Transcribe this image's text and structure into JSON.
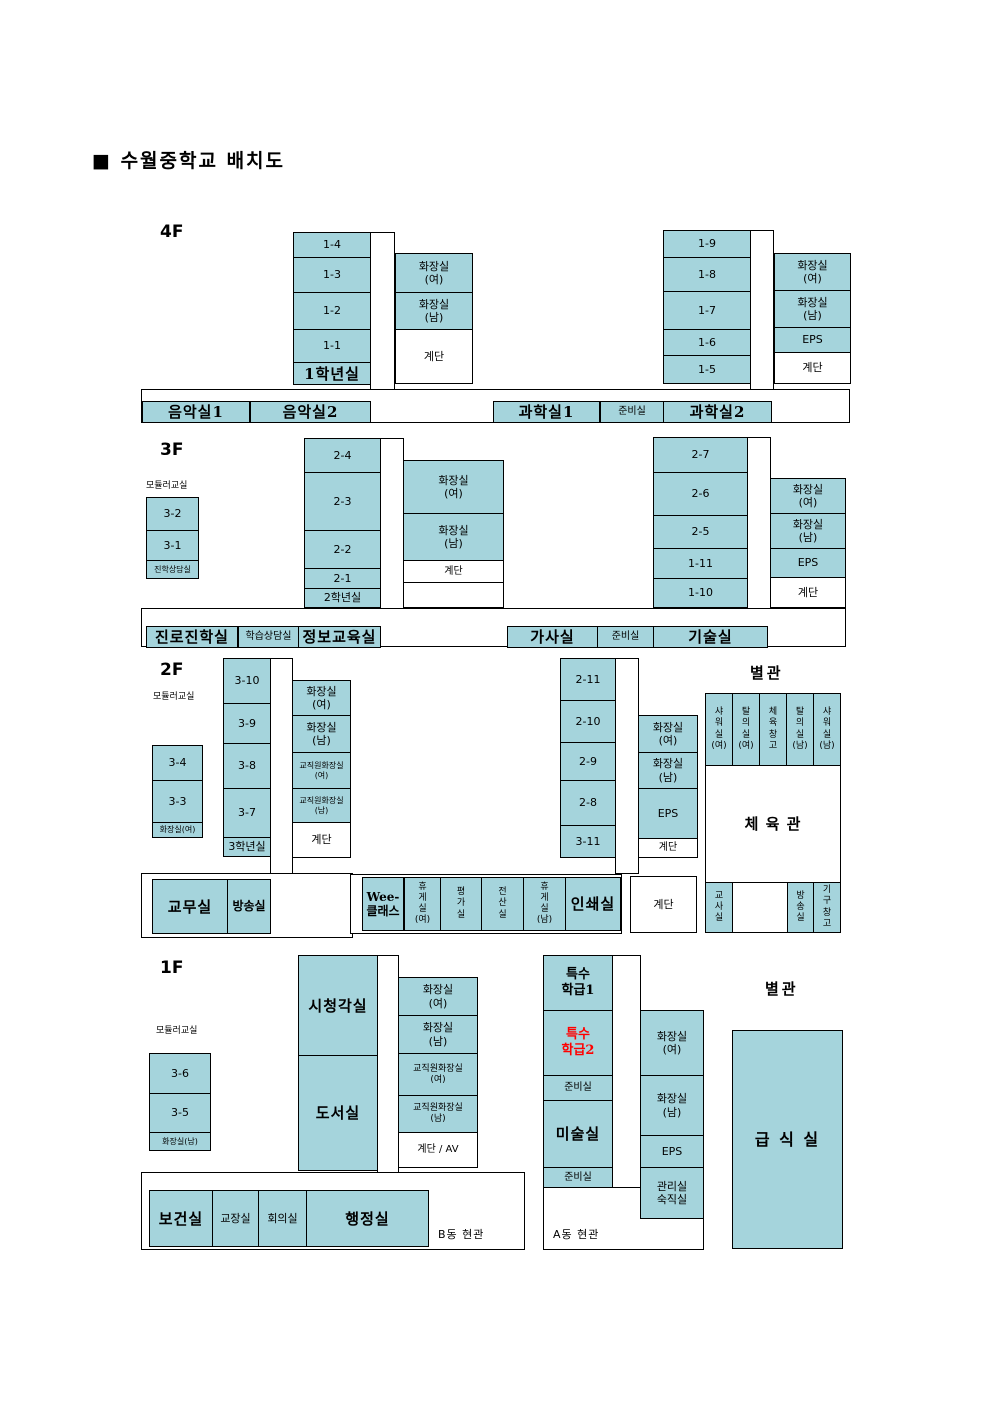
{
  "title": "■ 수월중학교 배치도",
  "colors": {
    "room_fill": "#a5d4dc",
    "line": "#000000",
    "highlight_text": "#ff0000"
  },
  "f4": {
    "label": "4F",
    "rooms_left": [
      "1-4",
      "1-3",
      "1-2",
      "1-1"
    ],
    "grade_office": "1학년실",
    "wc_left": [
      "화장실\n(여)",
      "화장실\n(남)"
    ],
    "stairs": "계단",
    "music_rooms": [
      "음악실1",
      "음악실2"
    ],
    "rooms_right": [
      "1-9",
      "1-8",
      "1-7",
      "1-6",
      "1-5"
    ],
    "wc_right": [
      "화장실\n(여)",
      "화장실\n(남)",
      "EPS"
    ],
    "science_rooms": [
      "과학실1",
      "준비실",
      "과학실2"
    ]
  },
  "f3": {
    "label": "3F",
    "modular_label": "모듈러교실",
    "modular_rooms": [
      "3-2",
      "3-1"
    ],
    "counsel_room": "진학상담실",
    "rooms_left": [
      "2-4",
      "2-3",
      "2-2",
      "2-1"
    ],
    "grade_office": "2학년실",
    "wc_left": [
      "화장실\n(여)",
      "화장실\n(남)"
    ],
    "stairs": "계단",
    "bottom_left": [
      "진로진학실",
      "학습상담실",
      "정보교육실"
    ],
    "rooms_right": [
      "2-7",
      "2-6",
      "2-5",
      "1-11",
      "1-10"
    ],
    "wc_right": [
      "화장실\n(여)",
      "화장실\n(남)",
      "EPS"
    ],
    "bottom_right": [
      "가사실",
      "준비실",
      "기술실"
    ]
  },
  "f2": {
    "label": "2F",
    "modular_label": "모듈러교실",
    "modular_rooms": [
      "3-4",
      "3-3"
    ],
    "modular_wc": "화장실(여)",
    "rooms_left": [
      "3-10",
      "3-9",
      "3-8",
      "3-7"
    ],
    "grade_office": "3학년실",
    "wc_left": [
      "화장실\n(여)",
      "화장실\n(남)",
      "교직원화장실\n(여)",
      "교직원화장실\n(남)"
    ],
    "stairs": "계단",
    "rooms_right": [
      "2-11",
      "2-10",
      "2-9",
      "2-8",
      "3-11"
    ],
    "wc_right": [
      "화장실\n(여)",
      "화장실\n(남)",
      "EPS"
    ],
    "office_row": [
      "교무실",
      "방송실"
    ],
    "mid_row": [
      "Wee-\n클래스",
      "휴\n게\n실\n(여)",
      "평\n가\n실",
      "전\n산\n실",
      "휴\n게\n실\n(남)",
      "인쇄실"
    ],
    "annex": {
      "label": "별관",
      "top_row": [
        "샤\n워\n실\n(여)",
        "탈\n의\n실\n(여)",
        "체\n육\n창\n고",
        "탈\n의\n실\n(남)",
        "샤\n워\n실\n(남)"
      ],
      "gym": "체 육 관",
      "bottom_row": [
        "교\n사\n실",
        "방\n송\n실",
        "기\n구\n창\n고"
      ]
    }
  },
  "f1": {
    "label": "1F",
    "modular_label": "모듈러교실",
    "modular_rooms": [
      "3-6",
      "3-5"
    ],
    "modular_wc": "화장실(남)",
    "av_room": "시청각실",
    "library": "도서실",
    "wc_left": [
      "화장실\n(여)",
      "화장실\n(남)",
      "교직원화장실\n(여)",
      "교직원화장실\n(남)"
    ],
    "stairs_av": "계단 / AV",
    "special_rooms": [
      "특수\n학급1",
      "특수\n학급2"
    ],
    "prep1": "준비실",
    "art_room": "미술실",
    "prep2": "준비실",
    "wc_right": [
      "화장실\n(여)",
      "화장실\n(남)",
      "EPS"
    ],
    "caretaker": "관리실\n숙직실",
    "entrance_a": "A동 현관",
    "entrance_b": "B동 현관",
    "admin_row": [
      "보건실",
      "교장실",
      "회의실",
      "행정실"
    ],
    "annex": {
      "label": "별관",
      "cafeteria": "급 식 실"
    }
  }
}
